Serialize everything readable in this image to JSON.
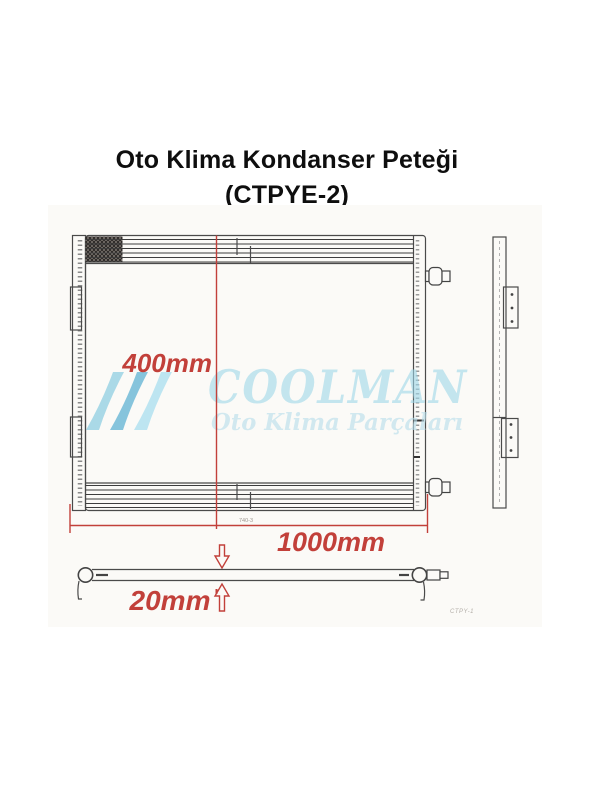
{
  "header": {
    "title_line1": "Oto Klima Kondanser Peteği",
    "title_line2": "(CTPYE-2)"
  },
  "drawing": {
    "dims": {
      "height_label": "400mm",
      "width_label": "1000mm",
      "depth_label": "20mm"
    },
    "notes": {
      "inner_dim_note": "740-3",
      "drawing_code": "CTPY-1"
    },
    "watermark": {
      "brand": "COOLMAN",
      "tagline": "Oto Klima Parçaları",
      "logo_icon": "triple-wave-icon"
    },
    "colors": {
      "dimension_red": "#c2403a",
      "line_gray": "#4a4a4a",
      "watermark_blue": "#9ed7e9"
    }
  }
}
